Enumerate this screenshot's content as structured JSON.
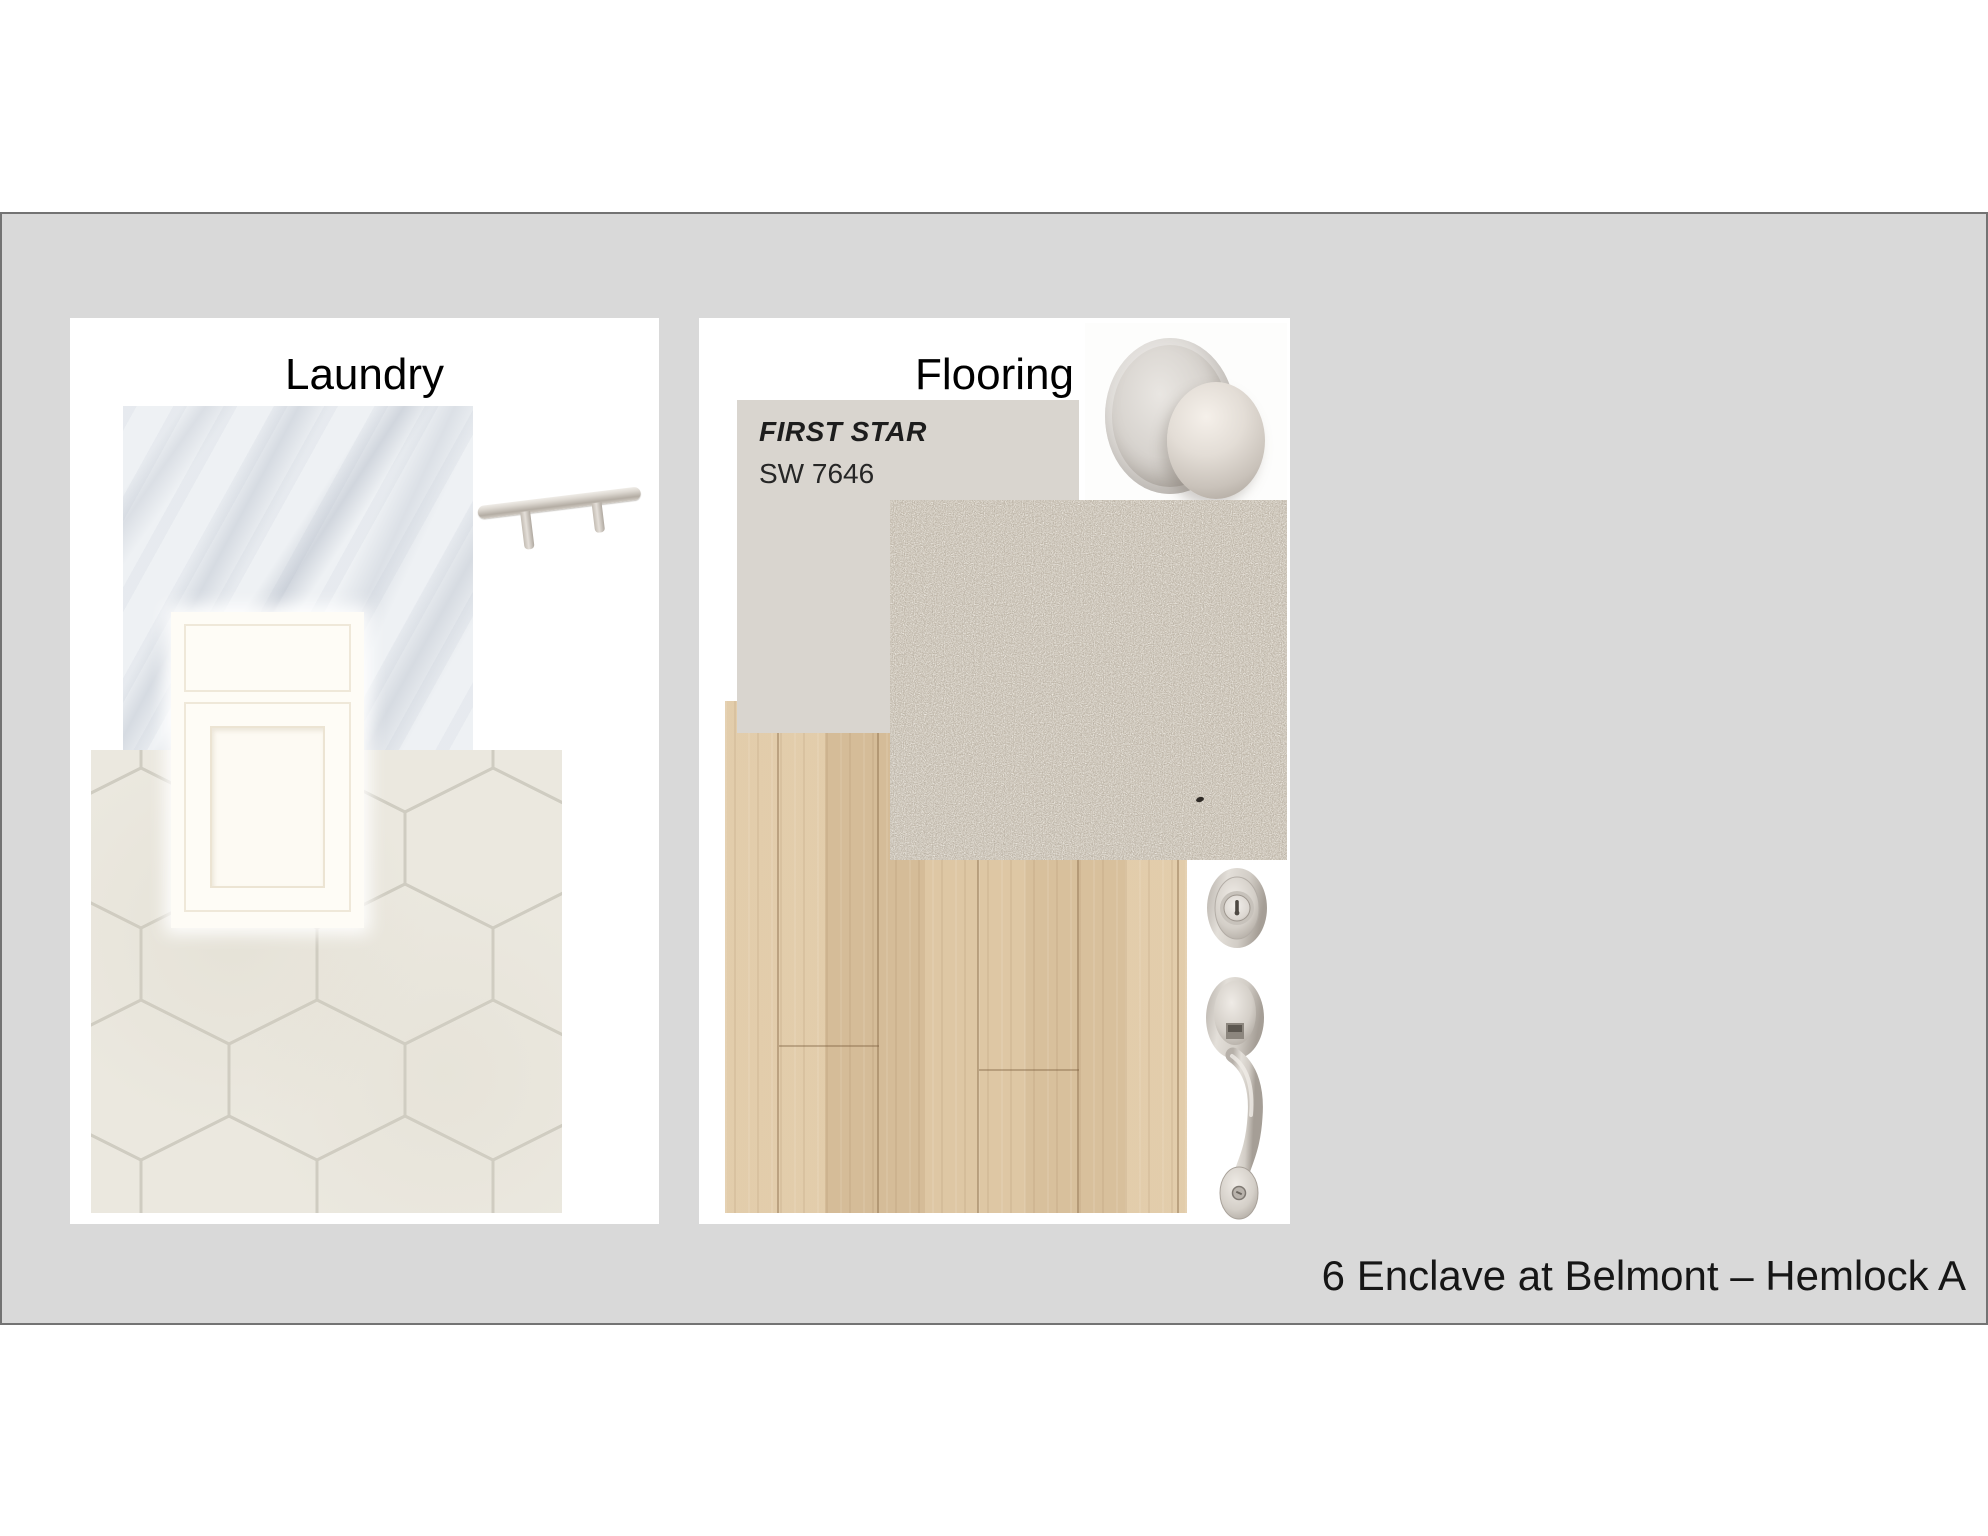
{
  "slide": {
    "caption": "6 Enclave at Belmont – Hemlock A",
    "background_color": "#d9d9d9",
    "border_color": "#737373"
  },
  "laundry_board": {
    "title": "Laundry",
    "swatches": {
      "countertop": "white-marble-countertop",
      "cabinet": "white-shaker-cabinet",
      "floor_tile": "cream-hexagon-floor-tile",
      "cabinet_pull": "satin-nickel-bar-pull"
    }
  },
  "flooring_board": {
    "title": "Flooring",
    "paint": {
      "name": "FIRST STAR",
      "code": "SW 7646",
      "swatch_color": "#d9d5cf"
    },
    "swatches": {
      "carpet": "beige-carpet",
      "hardwood": "light-oak-plank-flooring",
      "door_knob": "satin-nickel-door-knob",
      "deadbolt": "satin-nickel-deadbolt",
      "handleset": "satin-nickel-entry-handleset"
    }
  },
  "colors": {
    "carpet": "#c6bdaf",
    "hardwood": "#dcc5a2",
    "hex_tile": "#ebe8df",
    "tile_grout": "#cfccc1",
    "marble_base": "#eef1f4",
    "cabinet_white": "#fefcf6",
    "nickel_hardware": "#ccc6bf"
  }
}
